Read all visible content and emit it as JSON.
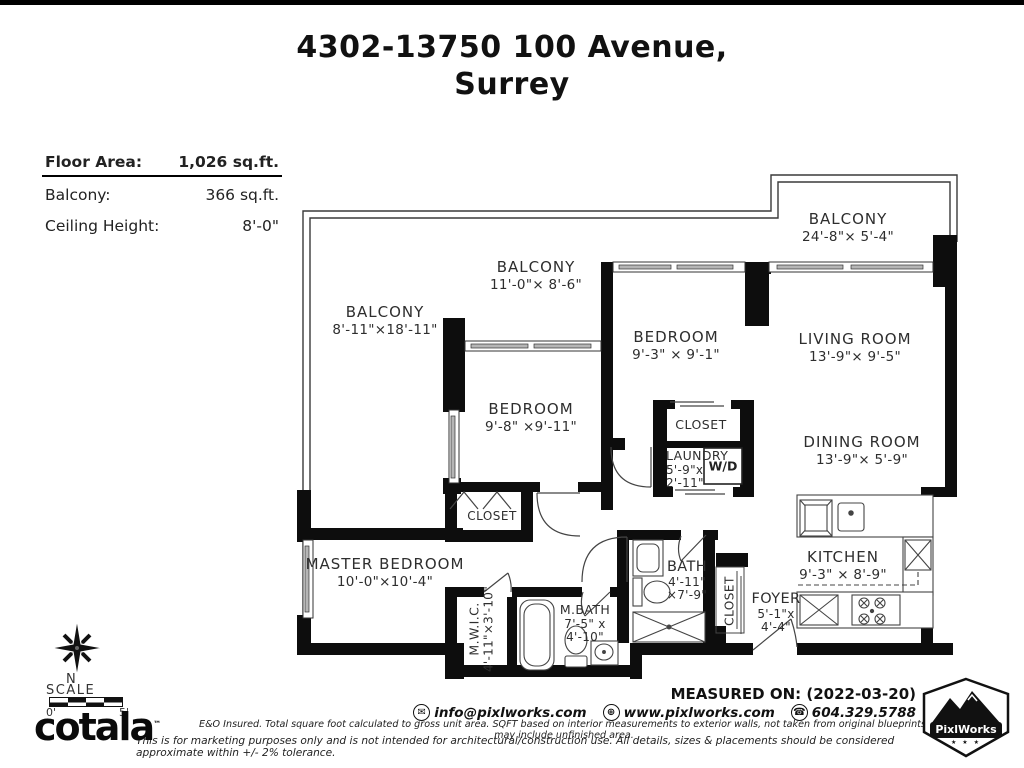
{
  "title": {
    "line1": "4302-13750 100 Avenue,",
    "line2": "Surrey"
  },
  "info": {
    "floor_area_label": "Floor Area:",
    "floor_area_value": "1,026 sq.ft.",
    "balcony_label": "Balcony:",
    "balcony_value": "366 sq.ft.",
    "ceiling_label": "Ceiling Height:",
    "ceiling_value": "8'-0\""
  },
  "rooms": {
    "balcony_left": {
      "name": "BALCONY",
      "dims": "8'-11\"×18'-11\""
    },
    "balcony_top": {
      "name": "BALCONY",
      "dims": "11'-0\"× 8'-6\""
    },
    "balcony_right": {
      "name": "BALCONY",
      "dims": "24'-8\"× 5'-4\""
    },
    "bedroom_mid": {
      "name": "BEDROOM",
      "dims": "9'-8\" ×9'-11\""
    },
    "bedroom_right": {
      "name": "BEDROOM",
      "dims": "9'-3\" × 9'-1\""
    },
    "living": {
      "name": "LIVING ROOM",
      "dims": "13'-9\"× 9'-5\""
    },
    "dining": {
      "name": "DINING ROOM",
      "dims": "13'-9\"× 5'-9\""
    },
    "kitchen": {
      "name": "KITCHEN",
      "dims": "9'-3\" × 8'-9\""
    },
    "foyer": {
      "name": "FOYER",
      "dims": "5'-1\"x",
      "dims2": "4'-4\""
    },
    "master": {
      "name": "MASTER BEDROOM",
      "dims": "10'-0\"×10'-4\""
    },
    "mwic": {
      "name": "M.W.I.C.",
      "dims": "4'-11\"×3'-10\""
    },
    "mbath": {
      "name": "M.BATH",
      "dims": "7'-5\" x",
      "dims2": "4'-10\""
    },
    "bath": {
      "name": "BATH",
      "dims": "4'-11\"",
      "dims2": "×7'-9\""
    },
    "laundry": {
      "name": "LAUNDRY",
      "dims": "5'-9\"x",
      "dims2": "2'-11\""
    },
    "closet_bedroom": {
      "name": "CLOSET"
    },
    "closet_hall": {
      "name": "CLOSET"
    },
    "closet_foyer": {
      "name": "CLOSET"
    },
    "wd": {
      "label": "W/D"
    }
  },
  "compass": {
    "north_label": "N",
    "scale_label": "SCALE",
    "scale_start": "0'",
    "scale_end": "5'"
  },
  "footer": {
    "measured_on": "MEASURED ON: (2022-03-20)",
    "email": "info@pixlworks.com",
    "website": "www.pixlworks.com",
    "phone": "604.329.5788",
    "disclaimer1": "E&O Insured.  Total square foot calculated to gross unit area. SQFT based on interior measurements to exterior walls, not taken from original blueprints, may include unfinished area.",
    "disclaimer2": "This is for marketing purposes only and is not intended for architectural/construction use.  All details, sizes & placements should be considered approximate within +/- 2%  tolerance.",
    "brand": "cotala",
    "brand_mark": "™",
    "pixlworks_name": "PixlWorks",
    "pixlworks_stars": "★ ★ ★"
  },
  "colors": {
    "wall": "#0d0d0d",
    "line": "#3a3a3a",
    "text": "#2e2e2e"
  }
}
